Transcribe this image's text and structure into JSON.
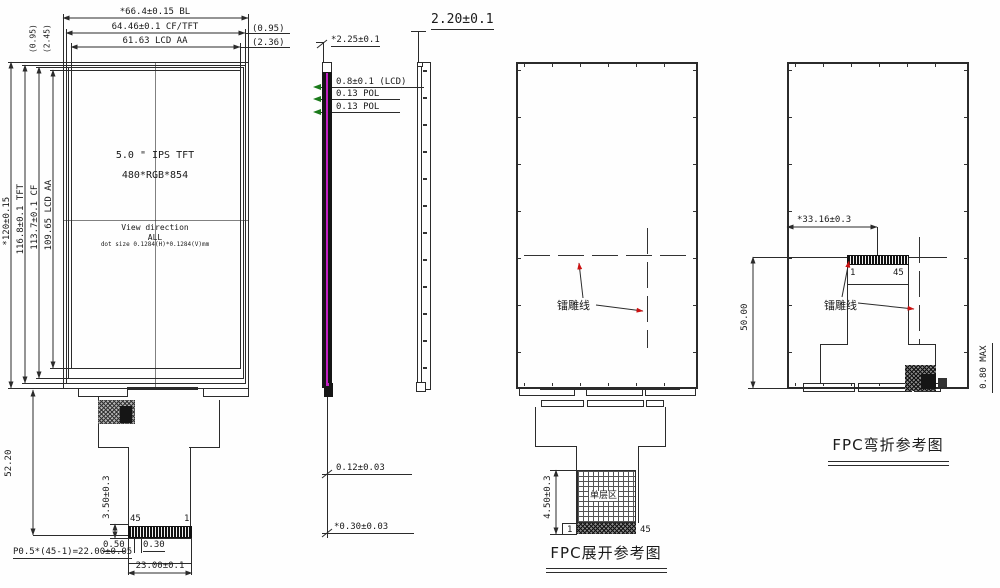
{
  "front": {
    "dim_bl": "*66.4±0.15 BL",
    "dim_cftft": "64.46±0.1 CF/TFT",
    "dim_aa": "61.63 LCD AA",
    "gap_right_1": "(0.95)",
    "gap_right_2": "(2.36)",
    "gap_left_1": "(0.95)",
    "gap_left_2": "(2.45)",
    "dim_h_bl": "*120±0.15",
    "dim_h_tft": "116.8±0.1 TFT",
    "dim_h_cf": "113.7±0.1 CF",
    "dim_h_aa": "109.65 LCD AA",
    "size_line1": "5.0 \" IPS TFT",
    "size_line2": "480*RGB*854",
    "view_dir_1": "View direction",
    "view_dir_2": "ALL",
    "dot_size": "dot size 0.1284(H)*0.1284(V)mm",
    "fpc_len": "52.20",
    "stiff_h": "3.50±0.3",
    "pin_l": "45",
    "pin_r": "1",
    "d_050": "0.50",
    "d_030": "0.30",
    "pitch": "P0.5*(45-1)=22.00±0.05",
    "conn_w": "23.00±0.1"
  },
  "side": {
    "total_t": "*2.25±0.1",
    "lcd_t": "0.8±0.1 (LCD)",
    "pol_t1": "0.13 POL",
    "pol_t2": "0.13 POL",
    "fpc_t": "0.12±0.03",
    "fpc_t2": "*0.30±0.03"
  },
  "profile": {
    "total_t": "2.20±0.1"
  },
  "back": {
    "laser": "镭雕线",
    "single_layer": "单层区",
    "pin_l": "1",
    "pin_r": "45",
    "fpc_h": "4.50±0.3",
    "caption": "FPC展开参考图"
  },
  "bend": {
    "offset": "*33.16±0.3",
    "height": "50.00",
    "pin_l": "1",
    "pin_r": "45",
    "laser": "镭雕线",
    "max_t": "0.80 MAX",
    "caption": "FPC弯折参考图"
  },
  "colors": {
    "line": "#2b2b2b",
    "pol_magenta": "#c320c3",
    "leader_red": "#cc1111",
    "arrow_green": "#1a7a1a"
  }
}
